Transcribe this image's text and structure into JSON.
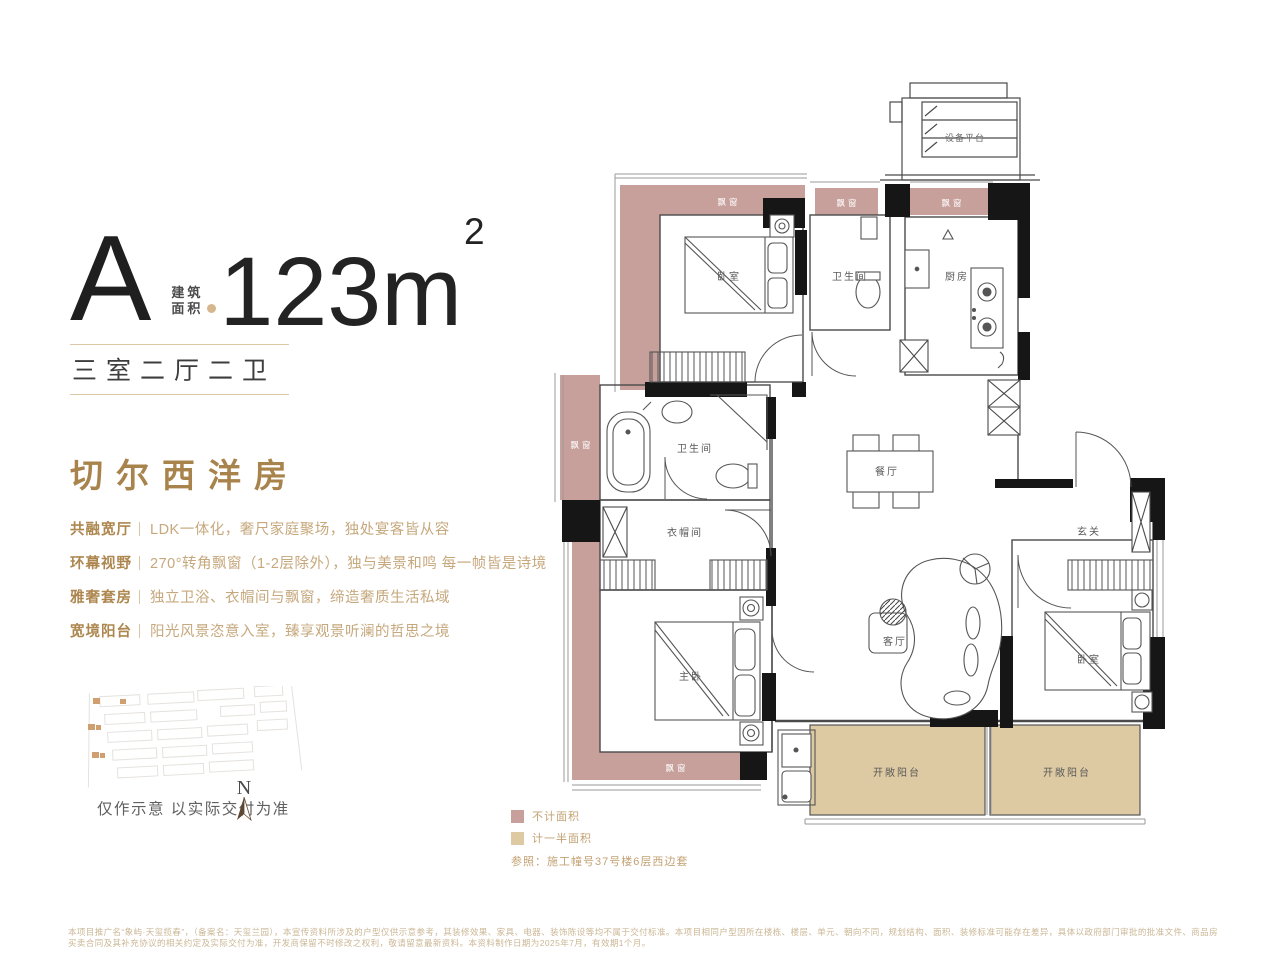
{
  "header": {
    "unit": "A",
    "area_label_line1": "建筑",
    "area_label_line2": "面积",
    "area_value": "123m",
    "area_sup": "2",
    "layout": "三室二厅二卫"
  },
  "intro": {
    "title": "切尔西洋房",
    "features": [
      {
        "label": "共融宽厅",
        "desc": "LDK一体化，奢尺家庭聚场，独处宴客皆从容"
      },
      {
        "label": "环幕视野",
        "desc": "270°转角飘窗（1-2层除外），独与美景和鸣 每一帧皆是诗境"
      },
      {
        "label": "雅奢套房",
        "desc": "独立卫浴、衣帽间与飘窗，缔造奢质生活私域"
      },
      {
        "label": "宽境阳台",
        "desc": "阳光风景恣意入室，臻享观景听澜的哲思之境"
      }
    ]
  },
  "siteplan": {
    "note": "仅作示意 以实际交付为准",
    "north": "N"
  },
  "plan": {
    "rooms": {
      "equipment": "设备平台",
      "bay": "飘窗",
      "bedroom1": "卧室",
      "bath1": "卫生间",
      "kitchen": "厨房",
      "bath2": "卫生间",
      "closet": "衣帽间",
      "dining": "餐厅",
      "foyer": "玄关",
      "master": "主卧",
      "living": "客厅",
      "bedroom2": "卧室",
      "balcony1": "开敞阳台",
      "balcony2": "开敞阳台"
    },
    "legend": [
      {
        "label": "不计面积",
        "color": "#c7a09c"
      },
      {
        "label": "计一半面积",
        "color": "#ddcaa2"
      }
    ],
    "reference": "参照：施工幢号37号楼6层西边套"
  },
  "colors": {
    "gold_text": "#c6a87c",
    "gold_title": "#a8834c",
    "bay_window_pink": "#c7a09c",
    "balcony_tan": "#ddcaa2",
    "wall_black": "#161616"
  },
  "footer": {
    "disclaimer": "本项目推广名“象屿·天玺揽春”，（备案名：天玺兰园），本宣传资料所涉及的户型仅供示意参考，其装修效果、家具、电器、装饰陈设等均不属于交付标准。本项目相同户型因所在楼栋、楼层、单元、朝向不同，规划结构、面积、装修标准可能存在差异，具体以政府部门审批的批准文件、商品房买卖合同及其补充协议的相关约定及实际交付为准，开发商保留不时修改之权利，敬请留意最新资料。本资料制作日期为2025年7月，有效期1个月。"
  }
}
